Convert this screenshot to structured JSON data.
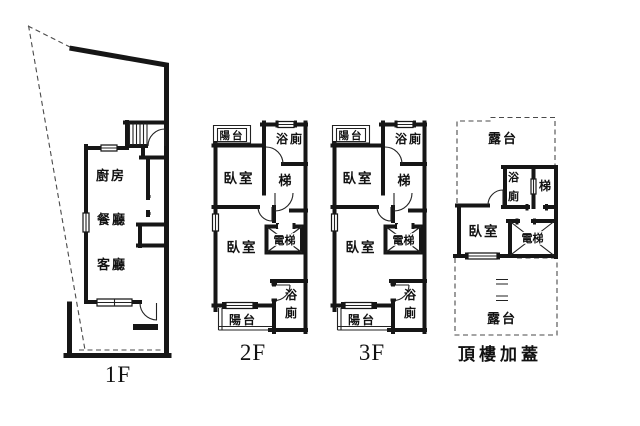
{
  "figure": {
    "type": "floor-plan-set",
    "floors_shown": [
      "1F",
      "2F",
      "3F",
      "頂樓加蓋"
    ]
  },
  "colors": {
    "wall": "#161616",
    "boundary_dash": "#4a4a4a",
    "background": "#ffffff"
  },
  "plans": {
    "f1": {
      "label": "1F",
      "kitchen": "廚房",
      "dining": "餐廳",
      "living": "客廳"
    },
    "f2": {
      "label": "2F",
      "balcony_top": "陽台",
      "bath_top": "浴廁",
      "bedroom_top": "臥室",
      "stair": "梯",
      "elevator": "電梯",
      "bedroom_bottom": "臥室",
      "bath_char_1": "浴",
      "bath_char_2": "廁",
      "balcony_bottom": "陽台"
    },
    "f3": {
      "label": "3F",
      "balcony_top": "陽台",
      "bath_top": "浴廁",
      "bedroom_top": "臥室",
      "stair": "梯",
      "elevator": "電梯",
      "bedroom_bottom": "臥室",
      "bath_char_1": "浴",
      "bath_char_2": "廁",
      "balcony_bottom": "陽台"
    },
    "roof": {
      "label": "頂樓加蓋",
      "terrace_top": "露台",
      "bath_char_1": "浴",
      "bath_char_2": "廁",
      "stair": "梯",
      "bedroom": "臥室",
      "elevator": "電梯",
      "terrace_bottom": "露台"
    }
  }
}
